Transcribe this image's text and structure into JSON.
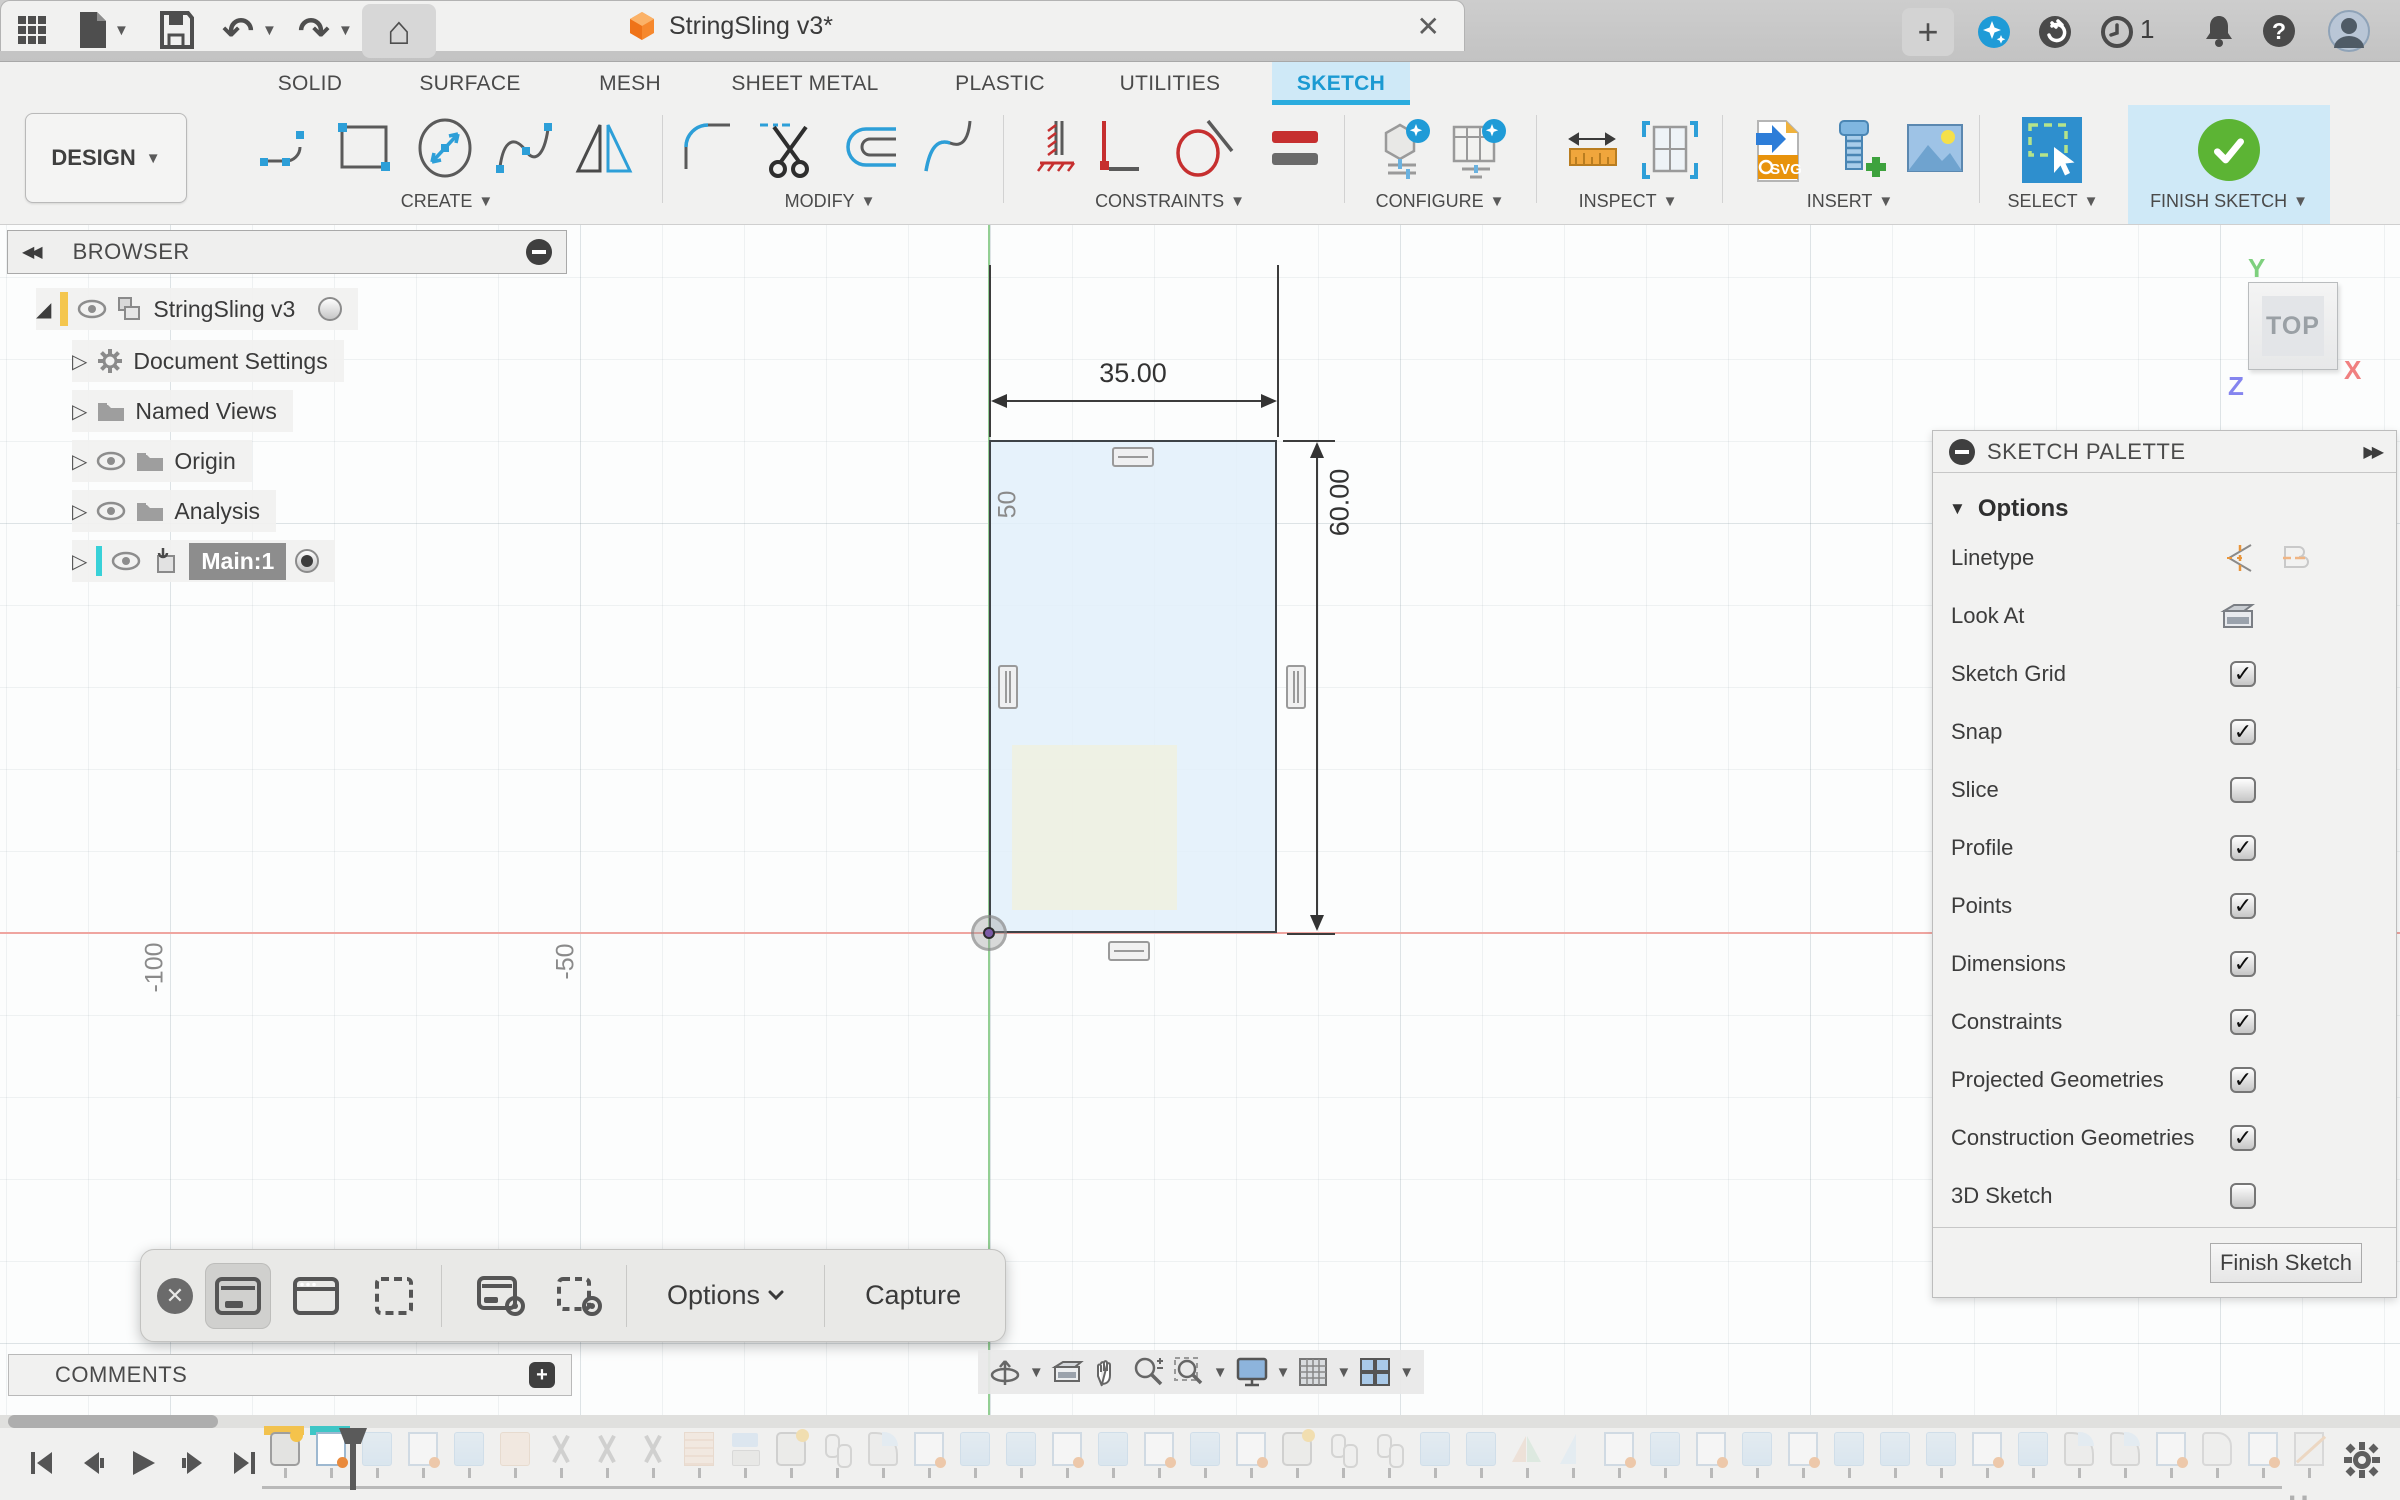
{
  "titlebar": {
    "title": "StringSling v3*",
    "job_count": "1",
    "icons": [
      "app-grid",
      "file-new",
      "save",
      "undo",
      "redo",
      "home",
      "close-tab",
      "new-tab",
      "ai-sparkle",
      "extensions",
      "job-status",
      "notifications",
      "help",
      "avatar"
    ]
  },
  "tabs": {
    "items": [
      {
        "label": "SOLID",
        "active": false
      },
      {
        "label": "SURFACE",
        "active": false
      },
      {
        "label": "MESH",
        "active": false
      },
      {
        "label": "SHEET METAL",
        "active": false
      },
      {
        "label": "PLASTIC",
        "active": false
      },
      {
        "label": "UTILITIES",
        "active": false
      },
      {
        "label": "SKETCH",
        "active": true
      }
    ],
    "active_color": "#29abe2"
  },
  "ribbon": {
    "design_label": "DESIGN",
    "groups": {
      "create": "CREATE",
      "modify": "MODIFY",
      "constraints": "CONSTRAINTS",
      "configure": "CONFIGURE",
      "inspect": "INSPECT",
      "insert": "INSERT",
      "select": "SELECT",
      "finish": "FINISH SKETCH"
    },
    "insert_svg_label": "SVG",
    "finish_green": "#5cb434"
  },
  "browser": {
    "title": "BROWSER",
    "items": [
      {
        "label": "StringSling v3",
        "selected": false
      },
      {
        "label": "Document Settings",
        "selected": false
      },
      {
        "label": "Named Views",
        "selected": false
      },
      {
        "label": "Origin",
        "selected": false
      },
      {
        "label": "Analysis",
        "selected": false
      },
      {
        "label": "Main:1",
        "selected": true
      }
    ],
    "accent_yellow": "#f4c64e",
    "accent_cyan": "#38d1d8"
  },
  "canvas": {
    "dim_width": "35.00",
    "dim_height": "60.00",
    "grid_label_50": "50",
    "grid_label_m100": "-100",
    "grid_label_m50": "-50",
    "sketch_fill": "#e2f0fa",
    "axis_x_color": "#efa5a0",
    "axis_y_color": "#93cf93",
    "viewcube": {
      "face": "TOP",
      "axis_x": "X",
      "axis_y": "Y",
      "axis_z": "Z"
    }
  },
  "palette": {
    "title": "SKETCH PALETTE",
    "section": "Options",
    "rows": [
      {
        "label": "Linetype",
        "control": "linetype-icons"
      },
      {
        "label": "Look At",
        "control": "lookat-icon"
      },
      {
        "label": "Sketch Grid",
        "control": "checkbox",
        "checked": true
      },
      {
        "label": "Snap",
        "control": "checkbox",
        "checked": true
      },
      {
        "label": "Slice",
        "control": "checkbox",
        "checked": false
      },
      {
        "label": "Profile",
        "control": "checkbox",
        "checked": true
      },
      {
        "label": "Points",
        "control": "checkbox",
        "checked": true
      },
      {
        "label": "Dimensions",
        "control": "checkbox",
        "checked": true
      },
      {
        "label": "Constraints",
        "control": "checkbox",
        "checked": true
      },
      {
        "label": "Projected Geometries",
        "control": "checkbox",
        "checked": true
      },
      {
        "label": "Construction Geometries",
        "control": "checkbox",
        "checked": true
      },
      {
        "label": "3D Sketch",
        "control": "checkbox",
        "checked": false
      }
    ],
    "finish_button": "Finish Sketch"
  },
  "capture_bar": {
    "options_label": "Options",
    "capture_label": "Capture",
    "tools": [
      "close",
      "capture-screen",
      "capture-window",
      "capture-selection",
      "record-screen",
      "record-selection"
    ]
  },
  "comments": {
    "label": "COMMENTS"
  },
  "navbar": {
    "tools": [
      "orbit",
      "look-at",
      "pan",
      "zoom",
      "fit",
      "display-settings",
      "grid-settings",
      "viewports"
    ]
  },
  "timeline": {
    "features": [
      {
        "type": "newcomp",
        "active": true,
        "marker": "yellow"
      },
      {
        "type": "sketch",
        "active": true,
        "marker": "teal"
      },
      {
        "type": "extrude",
        "active": false
      },
      {
        "type": "sketch",
        "active": false
      },
      {
        "type": "extrude",
        "active": false
      },
      {
        "type": "extrude-tan",
        "active": false
      },
      {
        "type": "scissors",
        "active": false
      },
      {
        "type": "scissors",
        "active": false
      },
      {
        "type": "scissors",
        "active": false
      },
      {
        "type": "ruler",
        "active": false
      },
      {
        "type": "combine",
        "active": false
      },
      {
        "type": "newcomp",
        "active": false
      },
      {
        "type": "pin",
        "active": false
      },
      {
        "type": "fillet",
        "active": false
      },
      {
        "type": "sketch",
        "active": false
      },
      {
        "type": "extrude",
        "active": false
      },
      {
        "type": "extrude",
        "active": false
      },
      {
        "type": "sketch",
        "active": false
      },
      {
        "type": "extrude",
        "active": false
      },
      {
        "type": "sketch",
        "active": false
      },
      {
        "type": "extrude",
        "active": false
      },
      {
        "type": "sketch",
        "active": false
      },
      {
        "type": "newcomp",
        "active": false
      },
      {
        "type": "pin",
        "active": false
      },
      {
        "type": "pin",
        "active": false
      },
      {
        "type": "extrude",
        "active": false
      },
      {
        "type": "extrude",
        "active": false
      },
      {
        "type": "mirror",
        "active": false
      },
      {
        "type": "triangle",
        "active": false
      },
      {
        "type": "sketch",
        "active": false
      },
      {
        "type": "extrude",
        "active": false
      },
      {
        "type": "sketch",
        "active": false
      },
      {
        "type": "extrude",
        "active": false
      },
      {
        "type": "sketch",
        "active": false
      },
      {
        "type": "extrude",
        "active": false
      },
      {
        "type": "extrude",
        "active": false
      },
      {
        "type": "extrude",
        "active": false
      },
      {
        "type": "sketch",
        "active": false
      },
      {
        "type": "extrude",
        "active": false
      },
      {
        "type": "fillet",
        "active": false
      },
      {
        "type": "fillet",
        "active": false
      },
      {
        "type": "sketch",
        "active": false
      },
      {
        "type": "prism",
        "active": false
      },
      {
        "type": "sketch",
        "active": false
      },
      {
        "type": "slash",
        "active": false
      }
    ]
  }
}
